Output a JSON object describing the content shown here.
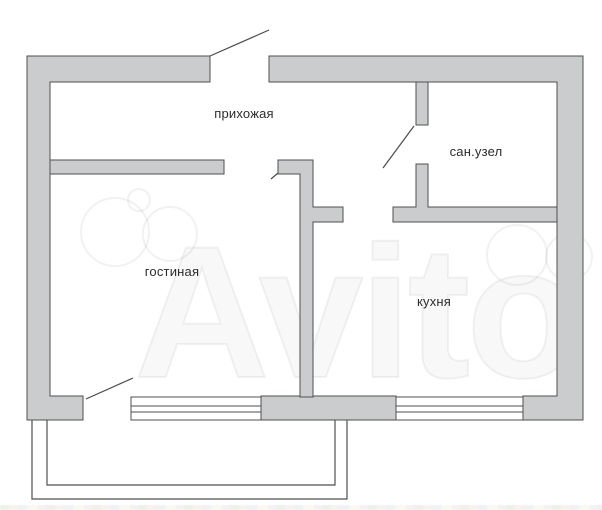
{
  "floorplan": {
    "rooms": [
      {
        "id": "hallway",
        "label": "прихожая"
      },
      {
        "id": "bathroom",
        "label": "сан.узел"
      },
      {
        "id": "living_room",
        "label": "гостиная"
      },
      {
        "id": "kitchen",
        "label": "кухня"
      }
    ],
    "elements": {
      "windows": [
        "living-room-window",
        "kitchen-window"
      ],
      "doors": [
        "entrance-door",
        "living-room-door",
        "bathroom-door",
        "kitchen-doorway",
        "balcony-door"
      ],
      "balcony": "balcony"
    },
    "watermark": {
      "brand": "Avito"
    },
    "colors": {
      "background": "#ffffff",
      "wall_fill": "#cbcccd",
      "wall_outline": "#4f4f4f",
      "door_line": "#4a4a4a",
      "label_text": "#2c2c2c",
      "watermark_line": "#e9e9e9"
    }
  }
}
